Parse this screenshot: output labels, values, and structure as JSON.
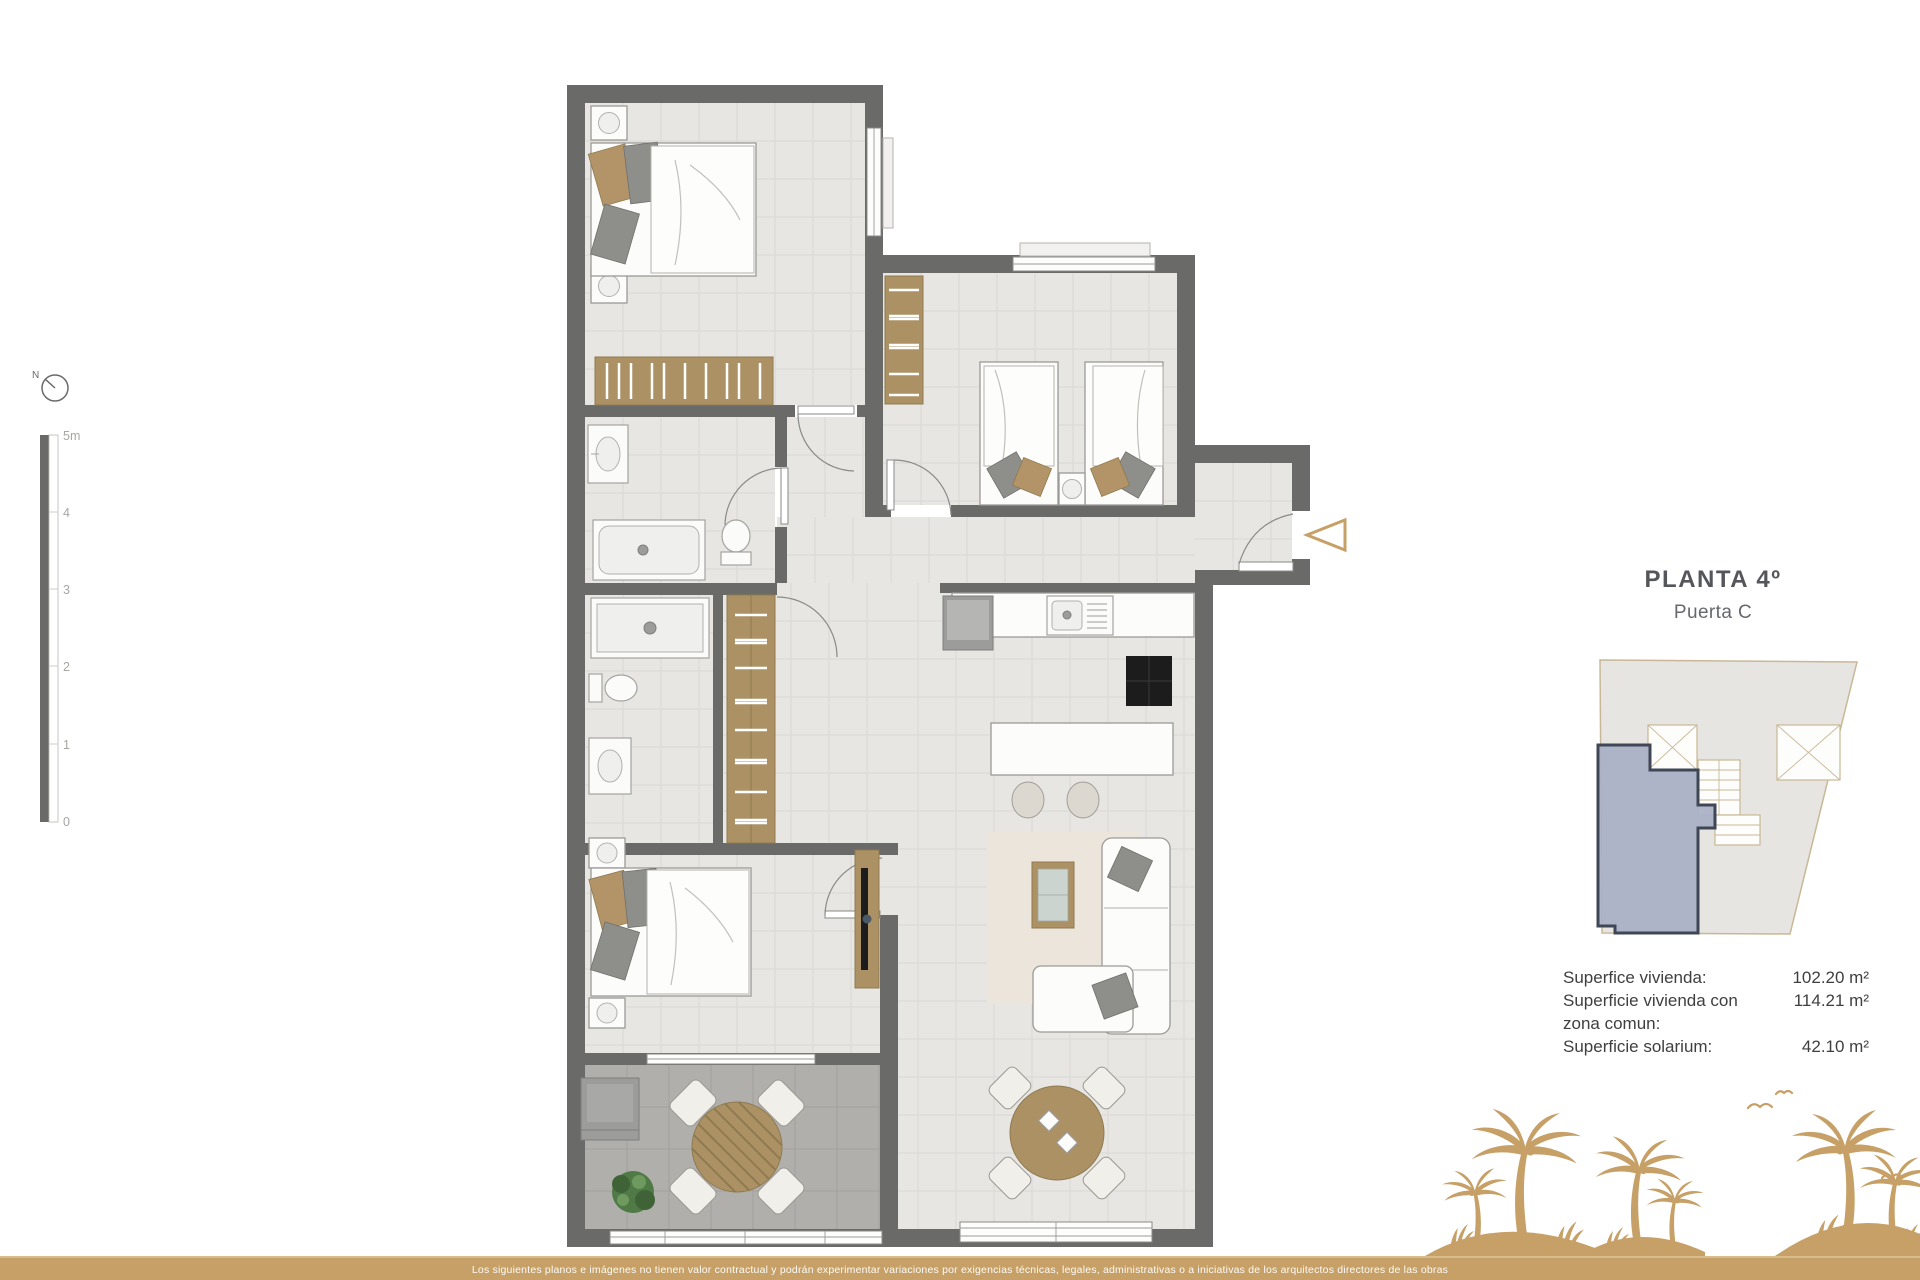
{
  "header": {
    "title": "PLANTA 4º",
    "subtitle": "Puerta C"
  },
  "compass": {
    "label": "N"
  },
  "scalebar": {
    "labels": [
      "5m",
      "4",
      "3",
      "2",
      "1",
      "0"
    ]
  },
  "areas": {
    "rows": [
      {
        "label": "Superfice vivienda:",
        "value": "102.20 m²"
      },
      {
        "label": "Superficie vivienda con zona comun:",
        "value": "114.21 m²"
      },
      {
        "label": "Superficie solarium:",
        "value": "42.10 m²"
      }
    ]
  },
  "footer": {
    "disclaimer": "Los siguientes planos e imágenes no tienen valor contractual y podrán experimentar variaciones por exigencias técnicas, legales, administrativas o a iniciativas de los arquitectos directores de las obras"
  },
  "icons": {
    "compass": "compass-icon",
    "entrance_arrow": "entrance-arrow-icon",
    "palms": "palm-trees-illustration"
  },
  "colors": {
    "accent": "#C6A066",
    "wall": "#6A6A69",
    "unit_highlight": "#A9B0C6",
    "unit_border": "#3F4656"
  }
}
